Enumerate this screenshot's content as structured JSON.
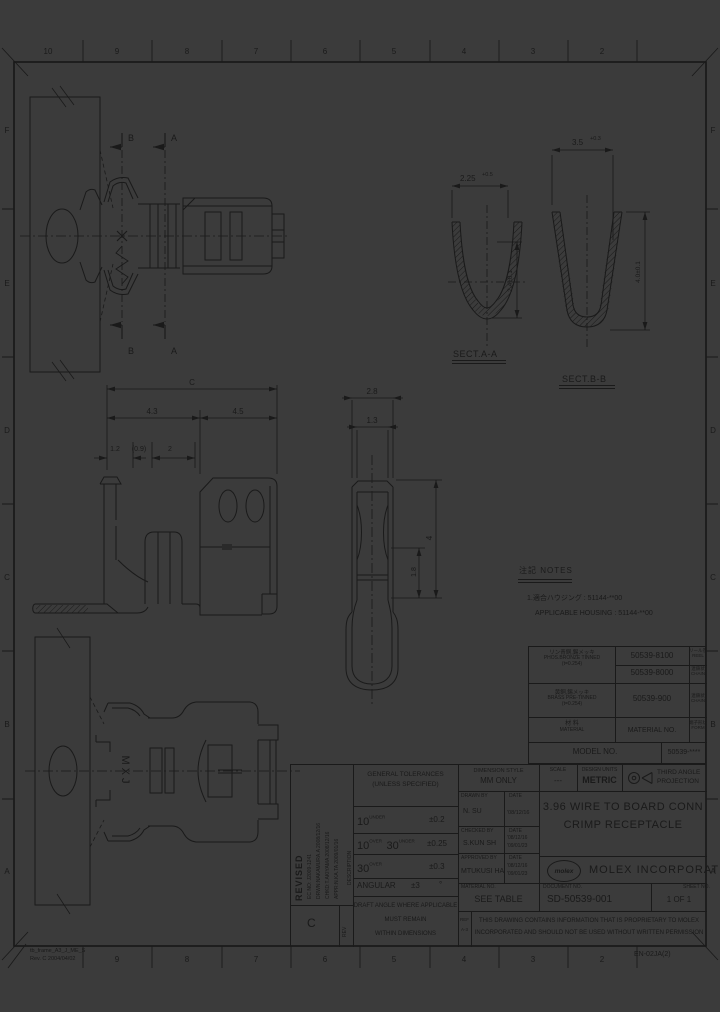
{
  "page": {
    "bg": "#3b3b3b",
    "ink": "#1a1a1a"
  },
  "frame": {
    "top_zones": [
      "10",
      "9",
      "8",
      "7",
      "6",
      "5",
      "4",
      "3",
      "2"
    ],
    "bottom_zones": [
      "9",
      "8",
      "7",
      "6",
      "5",
      "4",
      "3",
      "2"
    ],
    "left_zones": [
      "F",
      "E",
      "D",
      "C",
      "B",
      "A"
    ],
    "right_zones": [
      "F",
      "E",
      "D",
      "C",
      "B",
      "A"
    ],
    "frame_name": "tb_frame_A3_J_ME_S",
    "frame_rev": "Rev. C 2004/04/02",
    "doc_code": "EN-02JA(2)"
  },
  "notes": {
    "heading": "注記 NOTES",
    "line1": "1.適合ハウジング : 51144-**00",
    "line2": "APPLICABLE HOUSING : 51144-**00"
  },
  "parts_table": {
    "mat1_l1": "リン青銅,錫メッキ",
    "mat1_l2": "PHOS.BRONZE TINNED",
    "mat1_l3": "(t=0.254)",
    "pn1": "50539-8100",
    "form1_jp": "リール巻",
    "form1_en": "REEL",
    "pn2": "50539-8000",
    "form2_jp": "連鎖状",
    "form2_en": "CHAIN",
    "mat2_l1": "黄銅,錫メッキ",
    "mat2_l2": "BRASS PRE-TINNED",
    "mat2_l3": "(t=0.254)",
    "pn3": "50539-900",
    "form3_jp": "連鎖状",
    "form3_en": "CHAIN",
    "hdr_mat_jp": "材 料",
    "hdr_mat_en": "MATERIAL",
    "hdr_no": "MATERIAL NO.",
    "hdr_form_jp": "端子形状",
    "hdr_form_en": "FORM",
    "model_label": "MODEL NO.",
    "model_value": "50539-****"
  },
  "title_block": {
    "revised": "REVISED",
    "rev_line1": "EC NO: J2009-1241",
    "rev_line2": "DRWN:NAKAMURA.A  2008/12/16",
    "rev_line3": "CHKD:T.AKIYAMA  2008/12/16",
    "rev_line4": "APPR:N.KA.TA  2009/01/16",
    "description": "DESCRIPTION",
    "rev_label": "REV",
    "rev_value": "C",
    "tol_header1": "GENERAL TOLERANCES",
    "tol_header2": "(UNLESS SPECIFIED)",
    "tol1_a": "10",
    "tol1_as": "UNDER",
    "tol1_v": "±0.2",
    "tol2_a": "10",
    "tol2_as": "OVER",
    "tol2_b": "30",
    "tol2_bs": "UNDER",
    "tol2_v": "±0.25",
    "tol3_a": "30",
    "tol3_as": "OVER",
    "tol3_v": "±0.3",
    "tol4_label": "ANGULAR",
    "tol4_v": "±3",
    "tol4_unit": "°",
    "draft1": "DRAFT ANGLE WHERE APPLICABLE",
    "draft2": "MUST REMAIN",
    "draft3": "WITHIN DIMENSIONS",
    "dim_style_label": "DIMENSION STYLE",
    "dim_style_value": "MM ONLY",
    "scale_label": "SCALE",
    "scale_value": "---",
    "units_label": "DESIGN UNITS",
    "units_value": "METRIC",
    "proj_line1": "THIRD ANGLE",
    "proj_line2": "PROJECTION",
    "drawn_label": "DRAWN BY",
    "date_label": "DATE",
    "drawn_name": "N. SU",
    "drawn_date": "'08/12/16",
    "checked_label": "CHECKED BY",
    "checked_name": "S.KUN SH",
    "checked_date1": "'08/12/16",
    "checked_date2": "'09/01/23",
    "approved_label": "APPROVED BY",
    "approved_name": "MTUKUSI HA",
    "approved_date1": "'08/12/16",
    "approved_date2": "'09/01/23",
    "material_label": "MATERIAL NO.",
    "material_value": "SEE TABLE",
    "title1": "3.96 WIRE TO BOARD CONN",
    "title2": "CRIMP RECEPTACLE",
    "logo_text": "molex",
    "company": "MOLEX INCORPORATED",
    "document_label": "DOCUMENT NO.",
    "document_value": "SD-50539-001",
    "sheet_label": "SHEET NO.",
    "sheet_value": "1 OF 1",
    "ref_line1": "REF",
    "ref_line2": "A-3",
    "disclaimer1": "THIS DRAWING CONTAINS INFORMATION THAT IS PROPRIETARY TO MOLEX",
    "disclaimer2": "INCORPORATED AND SHOULD NOT BE USED WITHOUT WRITTEN PERMISSION"
  },
  "dims": {
    "overall": "C",
    "seg_a": "4.3",
    "seg_b": "4.5",
    "seg_c": "1.2",
    "seg_d": "(0.9)",
    "seg_e": "2",
    "front_w": "2.8",
    "front_inner": "1.3",
    "front_h": "4",
    "front_h2": "1.8",
    "secta_label": "SECT.A-A",
    "secta_w": "2.25",
    "secta_tol": "+0.5",
    "secta_h": "2.4±0.1",
    "sectb_label": "SECT.B-B",
    "sectb_w": "3.5",
    "sectb_tol": "+0.3",
    "sectb_h": "4.0±0.1",
    "arrow_a": "A",
    "arrow_b": "B",
    "marking": "MXJ"
  }
}
